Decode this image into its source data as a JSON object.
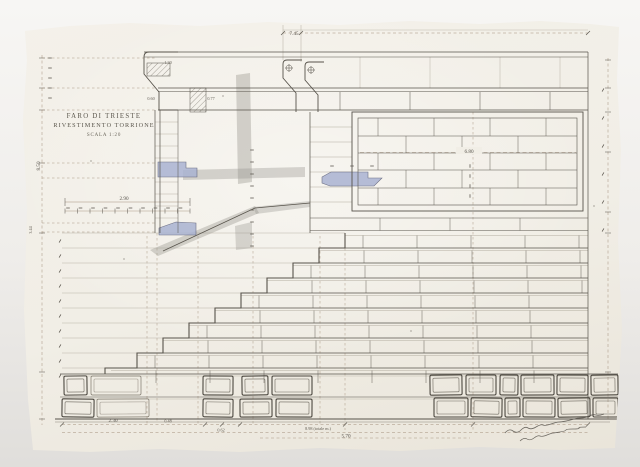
{
  "title_block": {
    "line1": "FARO DI TRIESTE",
    "line2": "RIVESTIMENTO TORRIONE",
    "line3": "SCALA 1:20"
  },
  "dimensions": {
    "top_width": "7.45",
    "panel_width": "6.80",
    "ledge_width": "2.90",
    "left_height_upper": "8.50",
    "left_height_lower": "3.44",
    "cornice_width": "1.30",
    "cornice_drop": "0.60",
    "cornice_offset": "0.77",
    "base_left": "2.30",
    "base_small": "0.48",
    "base_mid": "0.62",
    "base_total": "8.98 (totale m.)",
    "base_inner": "5.70"
  },
  "colors": {
    "paper": "#f2efe7",
    "background": "#eceae6",
    "ink": "#57534b",
    "pencil": "#b3ada0",
    "dimension_line": "#a4907c",
    "wash_blue": "#aab3d2",
    "wash_gray": "#96938c"
  }
}
